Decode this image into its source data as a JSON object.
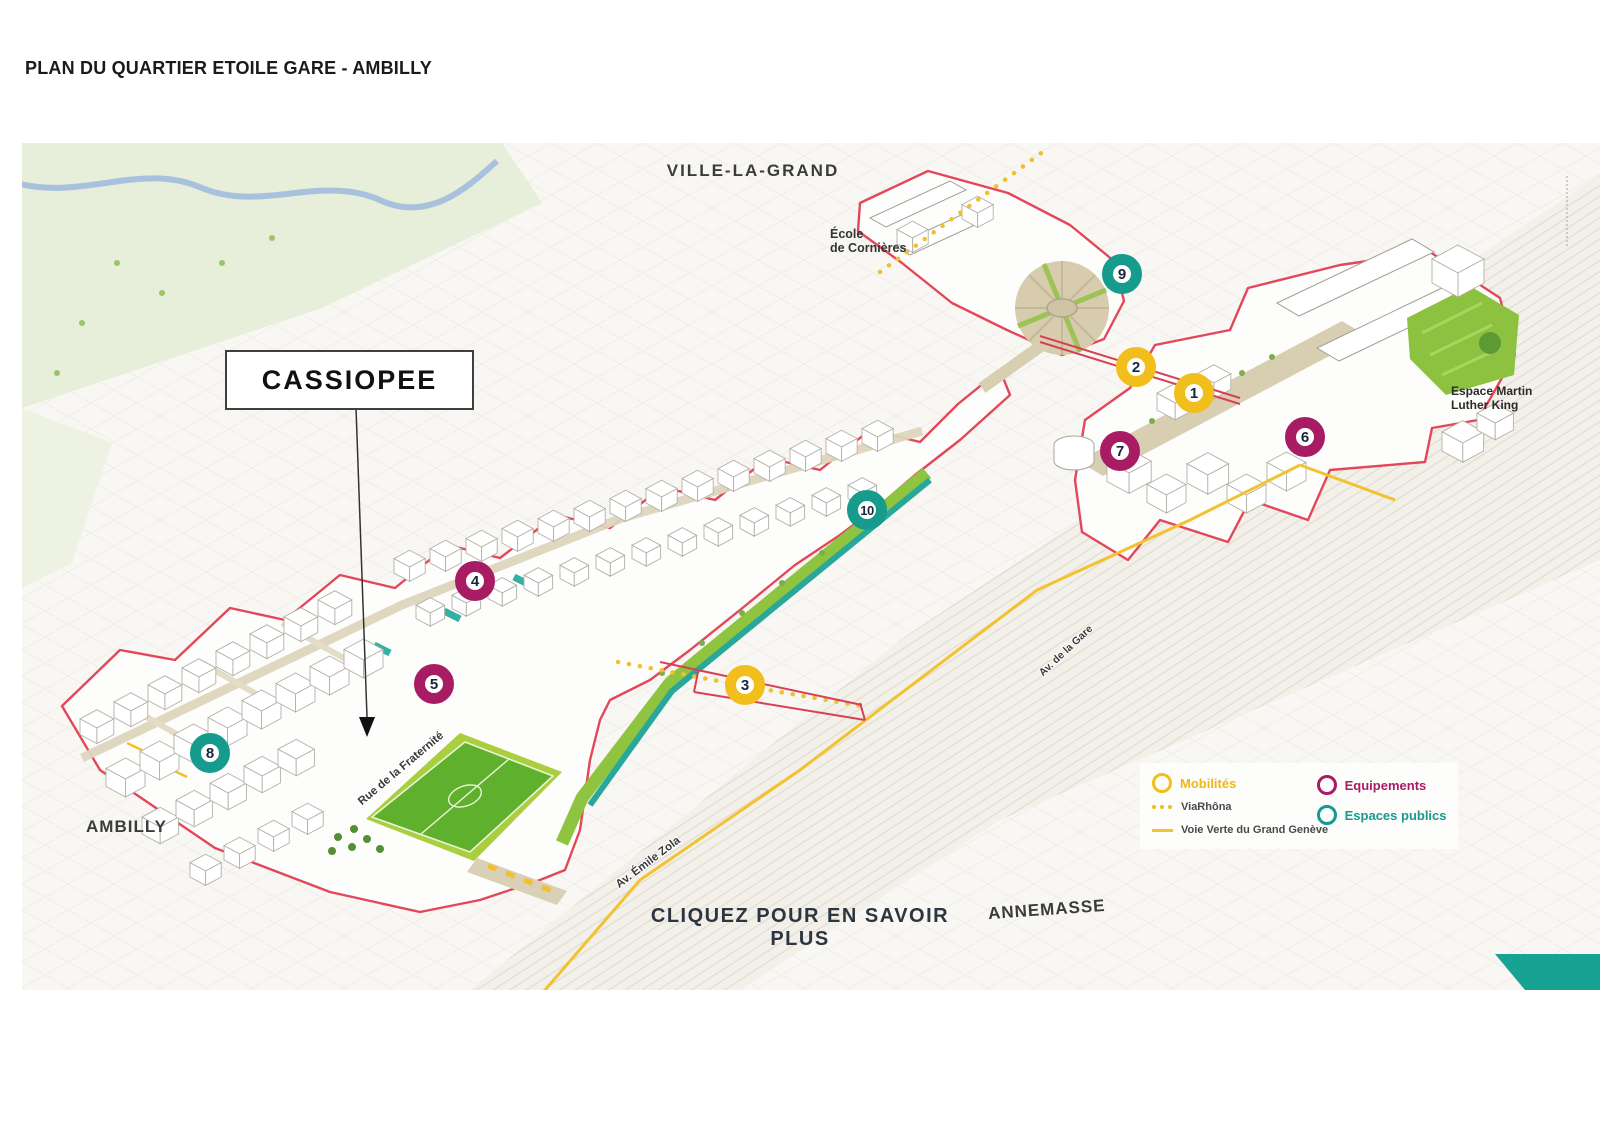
{
  "page": {
    "title": "PLAN DU QUARTIER ETOILE GARE - AMBILLY"
  },
  "map": {
    "cities": {
      "ville_la_grand": "VILLE-LA-GRAND",
      "ambilly": "AMBILLY",
      "annemasse": "ANNEMASSE"
    },
    "places": {
      "ecole_line1": "École",
      "ecole_line2": "de Cornières",
      "espace_line1": "Espace Martin",
      "espace_line2": "Luther King"
    },
    "streets": {
      "fraternite": "Rue de la Fraternité",
      "emile_zola": "Av. Émile Zola",
      "gare": "Av. de la Gare"
    },
    "callout": "CASSIOPEE",
    "cta": "CLIQUEZ POUR EN SAVOIR PLUS",
    "markers": [
      {
        "n": "1",
        "category": "mobilites"
      },
      {
        "n": "2",
        "category": "mobilites"
      },
      {
        "n": "3",
        "category": "mobilites"
      },
      {
        "n": "4",
        "category": "equipements"
      },
      {
        "n": "5",
        "category": "equipements"
      },
      {
        "n": "6",
        "category": "equipements"
      },
      {
        "n": "7",
        "category": "equipements"
      },
      {
        "n": "8",
        "category": "espaces_publics"
      },
      {
        "n": "9",
        "category": "espaces_publics"
      },
      {
        "n": "10",
        "category": "espaces_publics"
      }
    ]
  },
  "legend": {
    "mobilites": "Mobilités",
    "viarhona": "ViaRhôna",
    "voie_verte": "Voie Verte du Grand Genève",
    "equipements": "Equipements",
    "espaces_publics": "Espaces publics"
  },
  "colors": {
    "mobilites_yellow": "#F2BE1C",
    "equipements_magenta": "#A81C63",
    "espaces_publics_teal": "#169B8C",
    "boundary_red": "#E2475A",
    "voie_verte_yellow": "#F2C230",
    "field_green": "#5FB02C",
    "corner_teal": "#18A293"
  }
}
